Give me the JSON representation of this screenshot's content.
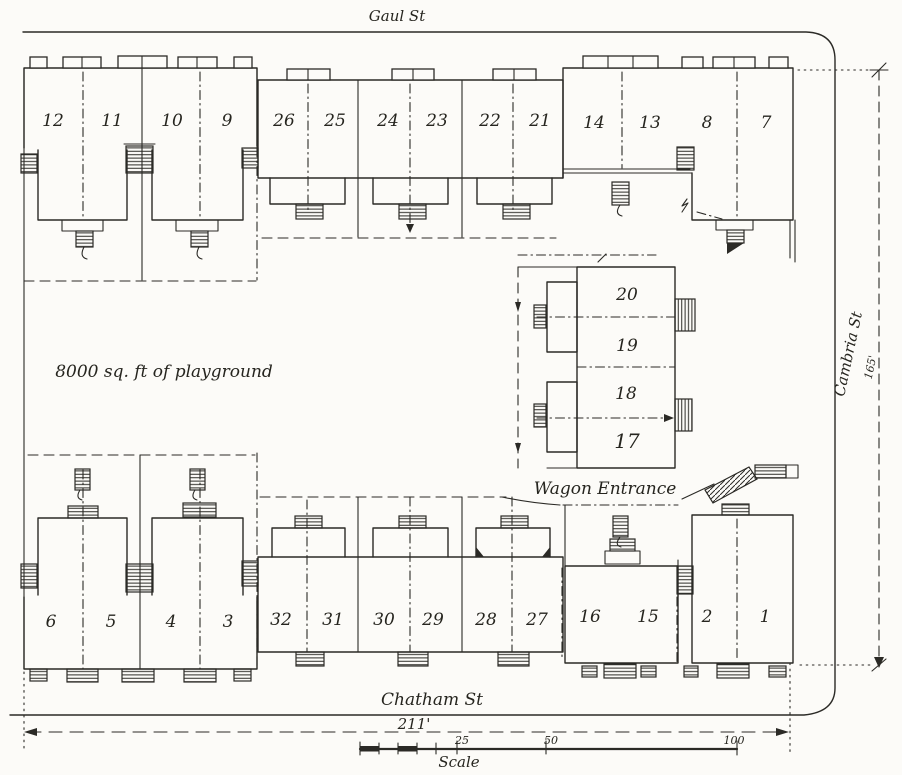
{
  "drawing": {
    "streets": {
      "top": "Gaul St",
      "right": "Cambria St",
      "bottom": "Chatham St"
    },
    "labels": {
      "playground": "8000 sq. ft of playground",
      "wagon_entrance": "Wagon Entrance"
    },
    "dimensions": {
      "lot_width": "211'",
      "lot_depth": "165'"
    },
    "scale_bar": {
      "label": "Scale",
      "ticks": [
        "25",
        "50",
        "100"
      ]
    },
    "blocks": {
      "top_left": {
        "units": [
          "12",
          "11",
          "10",
          "9"
        ]
      },
      "top_middle": {
        "units": [
          "26",
          "25",
          "24",
          "23",
          "22",
          "21"
        ]
      },
      "top_right": {
        "units": [
          "14",
          "13",
          "8",
          "7"
        ]
      },
      "middle_right": {
        "units": [
          "20",
          "19",
          "18",
          "17"
        ]
      },
      "bottom_left": {
        "units": [
          "6",
          "5",
          "4",
          "3"
        ]
      },
      "bottom_middle": {
        "units": [
          "32",
          "31",
          "30",
          "29",
          "28",
          "27"
        ]
      },
      "bottom_right": {
        "units": [
          "16",
          "15",
          "2",
          "1"
        ]
      }
    }
  }
}
